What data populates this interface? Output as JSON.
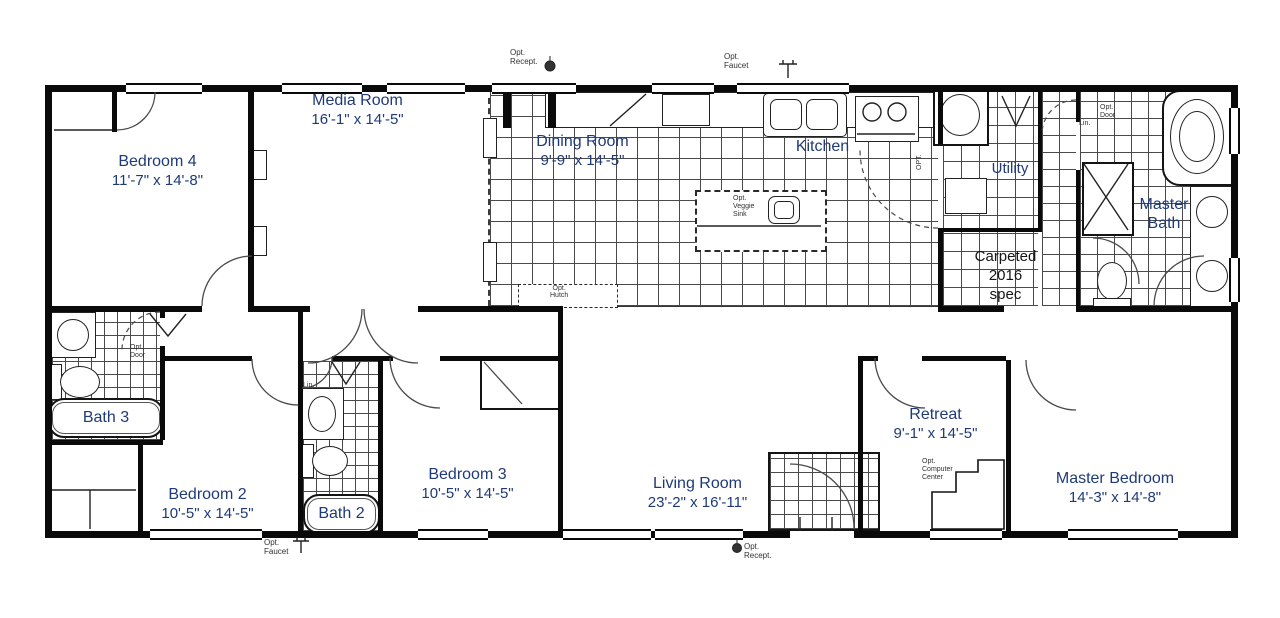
{
  "colors": {
    "room_label": "#1e3a78",
    "annotation": "#33302e",
    "carpet_note": "#161616",
    "wall": "#0a0a0a",
    "tile_line": "#4a4a4a"
  },
  "rooms": [
    {
      "name": "Bedroom 4",
      "dims": "11'-7\" x 14'-8\""
    },
    {
      "name": "Media Room",
      "dims": "16'-1\" x 14'-5\""
    },
    {
      "name": "Dining Room",
      "dims": "9'-9\" x 14'-5\""
    },
    {
      "name": "Kitchen",
      "dims": ""
    },
    {
      "name": "Utility",
      "dims": ""
    },
    {
      "name": "Master Bath",
      "dims": ""
    },
    {
      "name": "Bath 3",
      "dims": ""
    },
    {
      "name": "Bedroom 2",
      "dims": "10'-5\" x 14'-5\""
    },
    {
      "name": "Bath 2",
      "dims": ""
    },
    {
      "name": "Bedroom 3",
      "dims": "10'-5\" x 14'-5\""
    },
    {
      "name": "Living Room",
      "dims": "23'-2\" x 16'-11\""
    },
    {
      "name": "Retreat",
      "dims": "9'-1\" x 14'-5\""
    },
    {
      "name": "Master Bedroom",
      "dims": "14'-3\" x 14'-8\""
    }
  ],
  "annotations": [
    {
      "text": "Opt.\nRecept."
    },
    {
      "text": "Opt.\nFaucet"
    },
    {
      "text": "Opt.\nVeggie\nSink"
    },
    {
      "text": "OPT."
    },
    {
      "text": "Lin."
    },
    {
      "text": "Opt.\nDoor"
    },
    {
      "text": "Carpeted\n2016\nspec"
    },
    {
      "text": "Opt.\nHutch"
    },
    {
      "text": "Opt.\nDoor"
    },
    {
      "text": "Lin."
    },
    {
      "text": "Opt.\nComputer\nCenter"
    },
    {
      "text": "Opt.\nFaucet"
    },
    {
      "text": "Opt.\nRecept."
    }
  ]
}
